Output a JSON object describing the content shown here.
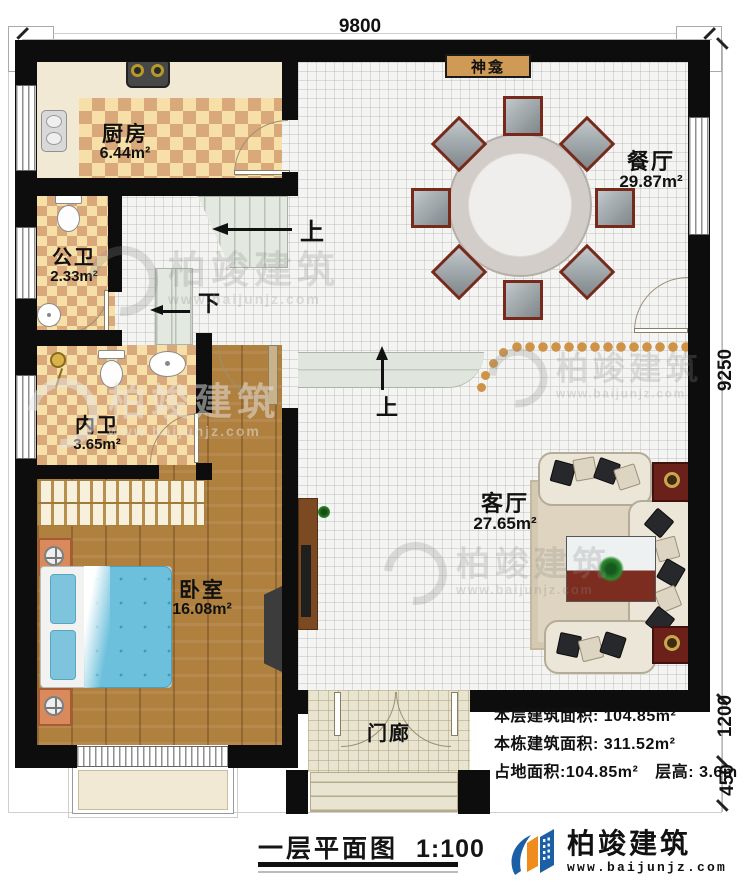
{
  "plan": {
    "dimensions": {
      "top": "9800",
      "right": "9250",
      "right_lower": "1200",
      "right_bottom": "450"
    },
    "rooms": {
      "kitchen": {
        "name": "厨房",
        "area": "6.44m²"
      },
      "public_bath": {
        "name": "公卫",
        "area": "2.33m²"
      },
      "private_bath": {
        "name": "内卫",
        "area": "3.65m²"
      },
      "bedroom": {
        "name": "卧室",
        "area": "16.08m²"
      },
      "dining": {
        "name": "餐厅",
        "area": "29.87m²"
      },
      "living": {
        "name": "客厅",
        "area": "27.65m²"
      },
      "porch": {
        "name": "门廊"
      },
      "shrine": {
        "name": "神龛"
      }
    },
    "stairs": {
      "up": "上",
      "down": "下"
    }
  },
  "info": {
    "lines": [
      {
        "label": "本层建筑面积: ",
        "value": "104.85m²"
      },
      {
        "label": "本栋建筑面积: ",
        "value": "311.52m²"
      },
      {
        "label": "占地面积:",
        "value": "104.85m²",
        "label2": "层高: ",
        "value2": "3.6m"
      }
    ]
  },
  "title": {
    "text": "一层平面图",
    "scale": "1:100"
  },
  "brand": {
    "name": "柏竣建筑",
    "site": "www.baijunjz.com"
  },
  "watermark": {
    "name": "柏竣建筑",
    "site": "www.baijunjz.com"
  },
  "colors": {
    "wall": "#0d0d0d",
    "tile_light": "#f7e0a8",
    "tile_dark": "#d9a97b",
    "wood": "#b0803f",
    "bead_dot": "#cf9348",
    "shrine_bg": "#cf9a55",
    "bed": "#6cc0dc",
    "logo_blue": "#1b5fa6",
    "logo_orange": "#f08c1e"
  }
}
